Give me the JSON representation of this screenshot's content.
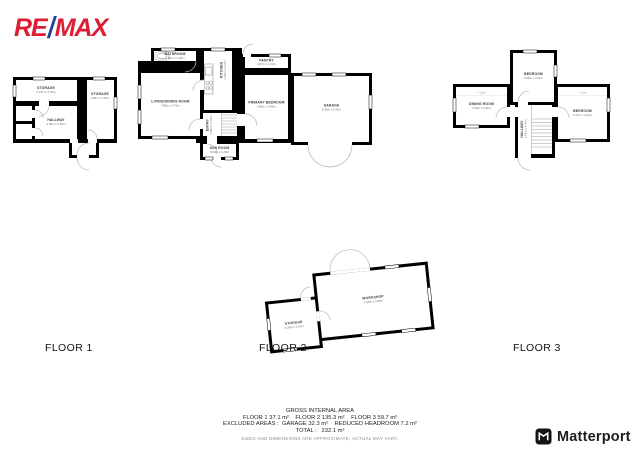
{
  "brand": {
    "remax_re": "RE",
    "remax_slash": "/",
    "remax_max": "MAX",
    "remax_red": "#DC1E35",
    "remax_blue": "#1B449C",
    "matterport_label": "Matterport"
  },
  "floor_labels": {
    "floor1": "FLOOR 1",
    "floor2": "FLOOR 2",
    "floor3": "FLOOR 3"
  },
  "floor1": {
    "storage_left": {
      "name": "STORAGE",
      "dims": "2.07m x 2.45m"
    },
    "hallway": {
      "name": "HALLWAY",
      "dims": "2.06m x 4.60m"
    },
    "storage_right": {
      "name": "STORAGE",
      "dims": "2.86m x 4.61m"
    }
  },
  "floor2": {
    "bathroom": {
      "name": "BATHROOM",
      "dims": "2.06m x 1.36m"
    },
    "kitchen": {
      "name": "KITCHEN",
      "dims": "2.06m x 2.16m"
    },
    "living": {
      "name": "LIVING/DINING ROOM",
      "dims": "4.85m x 4.75m"
    },
    "entry": {
      "name": "ENTRY",
      "dims": "3.08m x 1.62m"
    },
    "sunroom": {
      "name": "SUN ROOM",
      "dims": "3.09m x 1.20m"
    },
    "pantry": {
      "name": "PANTRY",
      "dims": "4.07m x 1.40m"
    },
    "primary_bedroom": {
      "name": "PRIMARY BEDROOM",
      "dims": "3.86m x 4.86m"
    },
    "garage": {
      "name": "GARAGE",
      "dims": "5.96m x 5.41m"
    }
  },
  "floor3": {
    "bedroom_top": {
      "name": "BEDROOM",
      "dims": "3.05m x 4.31m"
    },
    "dining": {
      "name": "DINING ROOM",
      "dims": "4.36m x 3.41m"
    },
    "bedroom_right": {
      "name": "BEDROOM",
      "dims": "4.47m x 4.01m"
    },
    "hallway": {
      "name": "HALLWAY",
      "dims": "1.04m x 4.34m"
    },
    "headroom_left": "< 1.5m",
    "headroom_right": "< 1.5m"
  },
  "outbuilding": {
    "workshop": {
      "name": "WORKSHOP",
      "dims": "7.96m x 3.96m"
    },
    "storage": {
      "name": "STORAGE",
      "dims": "4.26m x 2.51m"
    }
  },
  "summary": {
    "title": "GROSS INTERNAL AREA",
    "floors_line": "FLOOR 1 37.1 m²    FLOOR 2 135.3 m²    FLOOR 3 59.7 m²",
    "excluded_line": "EXCLUDED AREAS :  GARAGE 32.3 m²    REDUCED HEADROOM 7.2 m²",
    "total_line": "TOTAL :   232.1 m²",
    "disclaimer": "SIZES AND DIMENSIONS ARE APPROXIMATE, ACTUAL MAY VARY."
  }
}
